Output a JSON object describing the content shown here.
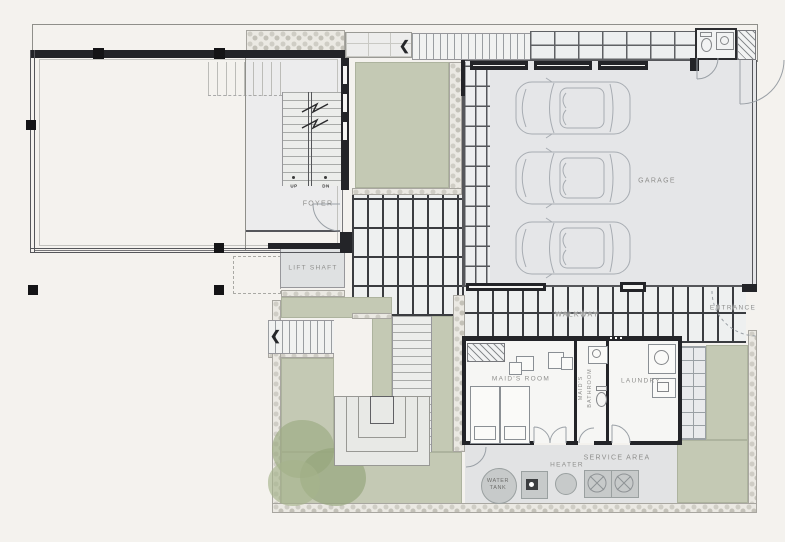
{
  "labels": {
    "foyer": "FOYER",
    "lift_shaft": "LIFT SHAFT",
    "garage": "GARAGE",
    "walkway": "WALKWAY",
    "entrance": "ENTRANCE",
    "maids_room": "MAID'S ROOM",
    "maids_bathroom_word1": "MAID'S",
    "maids_bathroom_word2": "BATHROOM",
    "laundry": "LAUNDRY",
    "service_area": "SERVICE AREA",
    "heater": "HEATER",
    "water_tank_word1": "WATER",
    "water_tank_word2": "TANK",
    "stair_up": "UP",
    "stair_dn": "DN"
  },
  "icons": {
    "direction_arrow_left": "❮"
  },
  "counts": {
    "garage_cars": 3,
    "ac_condenser_units": 2,
    "maids_room_beds": 2
  },
  "colors": {
    "background": "#f4f2ee",
    "plan_green": "#c4c9b4",
    "garage_floor": "#e5e6e8",
    "wall_dark": "#232428",
    "walkway_tile_line": "#3a3c40",
    "label_text": "#8f8f8d",
    "equipment_fill": "#c7caca"
  }
}
